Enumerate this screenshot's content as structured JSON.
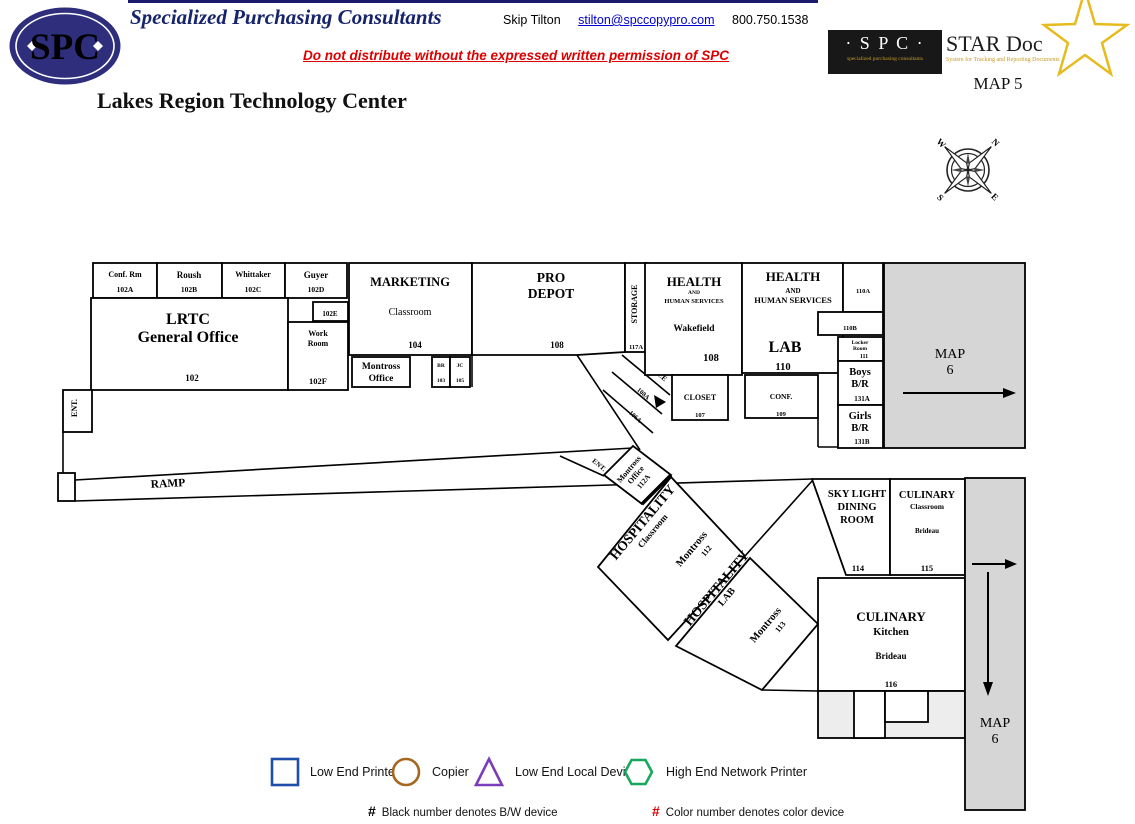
{
  "header": {
    "logo_text": "SPC",
    "company": "Specialized Purchasing Consultants",
    "contact_name": "Skip Tilton",
    "contact_email": "stilton@spccopypro.com",
    "contact_phone": "800.750.1538",
    "warning": "Do not distribute without the expressed written permission of SPC",
    "facility": "Lakes Region Technology Center",
    "map_label": "MAP 5",
    "stardoc": {
      "spc": "· S P C ·",
      "tagline_left": "specialized purchasing consultants",
      "title": "STAR Doc",
      "tagline_right": "System for Tracking and Reporting Documents"
    }
  },
  "compass": {
    "n": "N",
    "e": "E",
    "s": "S",
    "w": "W"
  },
  "labels": {
    "ent_left": "ENT.",
    "ent_wing": "ENT.",
    "ramp": "RAMP"
  },
  "map_links": {
    "right": {
      "l1": "MAP",
      "l2": "6"
    },
    "bottom": {
      "l1": "MAP",
      "l2": "6"
    }
  },
  "rooms": {
    "conf_rm": {
      "name": "Conf. Rm",
      "num": "102A"
    },
    "roush": {
      "name": "Roush",
      "num": "102B"
    },
    "whittaker": {
      "name": "Whittaker",
      "num": "102C"
    },
    "guyer": {
      "name": "Guyer",
      "num": "102D"
    },
    "lrtc": {
      "l1": "LRTC",
      "l2": "General Office",
      "num": "102"
    },
    "room_102e": {
      "num": "102E"
    },
    "work_room": {
      "l1": "Work",
      "l2": "Room",
      "num": "102F"
    },
    "marketing": {
      "l1": "MARKETING",
      "l2": "Classroom",
      "num": "104"
    },
    "montross_office": {
      "l1": "Montross",
      "l2": "Office"
    },
    "br": {
      "name": "BR",
      "num": "103"
    },
    "jc": {
      "name": "JC",
      "num": "105"
    },
    "pro_depot": {
      "l1": "PRO",
      "l2": "DEPOT",
      "num": "108"
    },
    "storage": {
      "name": "STORAGE",
      "num": "117A"
    },
    "office_diag": {
      "name": "OFFICE",
      "num1": "108A",
      "num2": "106A"
    },
    "hhs_wakefield": {
      "l1": "HEALTH",
      "l2": "AND",
      "l3": "HUMAN SERVICES",
      "l4": "Wakefield",
      "num": "108"
    },
    "closet": {
      "name": "CLOSET",
      "num": "107"
    },
    "hhs_lab": {
      "l1": "HEALTH",
      "l2": "AND",
      "l3": "HUMAN SERVICES",
      "l4": "LAB",
      "num": "110"
    },
    "conf": {
      "name": "CONF.",
      "num": "109"
    },
    "room_110a": {
      "num": "110A"
    },
    "room_110b": {
      "num": "110B"
    },
    "locker": {
      "l1": "Locker",
      "l2": "Room",
      "num": "111"
    },
    "boys": {
      "l1": "Boys",
      "l2": "B/R",
      "num": "131A"
    },
    "girls": {
      "l1": "Girls",
      "l2": "B/R",
      "num": "131B"
    },
    "montross_112a": {
      "l1": "Montross",
      "l2": "Office",
      "num": "112A"
    },
    "hosp_class": {
      "l1": "HOSPITALITY",
      "l2": "Classroom",
      "l3": "Montross",
      "num": "112"
    },
    "hosp_lab": {
      "l1": "HOSPITALITY",
      "l2": "LAB",
      "l3": "Montross",
      "num": "113"
    },
    "skylight": {
      "l1": "SKY LIGHT",
      "l2": "DINING",
      "l3": "ROOM",
      "num": "114"
    },
    "culinary_class": {
      "l1": "CULINARY",
      "l2": "Classroom",
      "l3": "Brideau",
      "num": "115"
    },
    "culinary_kitchen": {
      "l1": "CULINARY",
      "l2": "Kitchen",
      "l3": "Brideau",
      "num": "116"
    }
  },
  "legend": {
    "items": [
      {
        "shape": "square-icon",
        "color": "#1f4faa",
        "label": "Low End Printer"
      },
      {
        "shape": "circle-icon",
        "color": "#a5661e",
        "label": "Copier"
      },
      {
        "shape": "triangle-icon",
        "color": "#7a3cb8",
        "label": "Low End Local Device"
      },
      {
        "shape": "hexagon-icon",
        "color": "#17a85e",
        "label": "High End Network Printer"
      }
    ],
    "notes": [
      {
        "mark": "#",
        "mark_color": "#000000",
        "text": "Black number denotes B/W device"
      },
      {
        "mark": "#",
        "mark_color": "#dd0000",
        "text": "Color number denotes color device"
      }
    ]
  }
}
